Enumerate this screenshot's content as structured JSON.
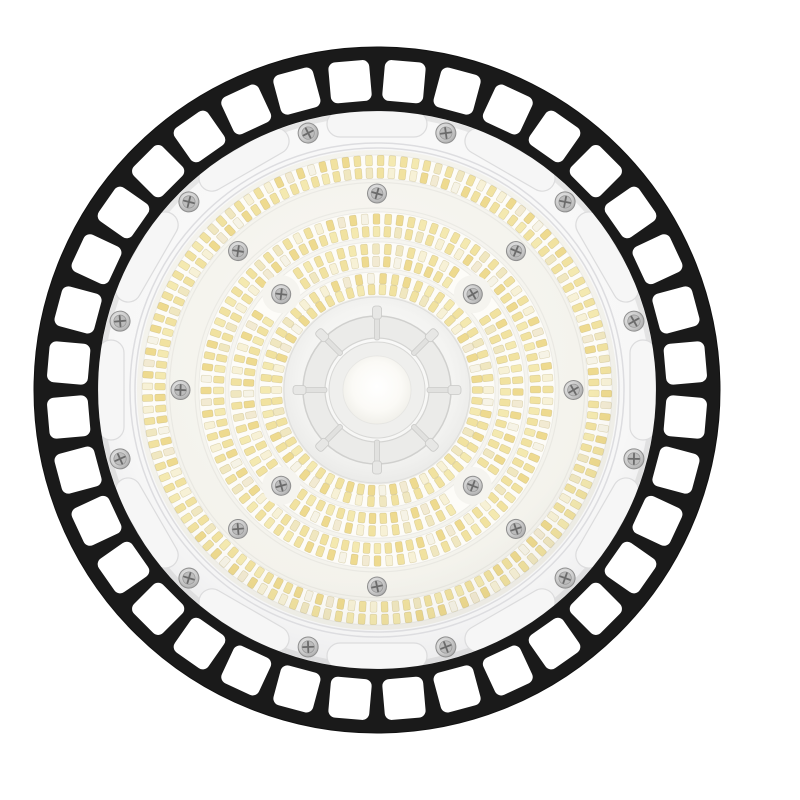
{
  "image": {
    "subject": "UFO LED high bay light fixture, front view, white background",
    "background_color": "#ffffff"
  },
  "fixture": {
    "center": {
      "x": 377,
      "y": 390
    },
    "cage": {
      "color": "#1a1a1a",
      "outer_radius": 343,
      "inner_radius": 279,
      "window_count": 36,
      "window_center_radius": 309.5,
      "window_size": 41,
      "window_corner_radius": 7,
      "first_window_angle_deg": 95,
      "window_fill": "#ffffff"
    },
    "bezel": {
      "outer_radius": 279,
      "recess_count": 12,
      "recess_center_radius": 266,
      "recess_width": 100,
      "recess_height": 26,
      "recess_fill": "#f6f6f6",
      "recess_stroke": "#dcdcdd",
      "groove_radii": [
        247,
        242
      ],
      "groove_color": "#dddde0",
      "screw_count": 12,
      "screw_ring_radius": 266,
      "screw_first_angle_deg": 15,
      "screw_head_radius": 10
    },
    "led_panel": {
      "tray_radius": 240,
      "tray_tint": "#f5f4ee",
      "gap_arc_radii": [
        207.5,
        182
      ],
      "band_backing_fill": "#fdfcf8",
      "bands": [
        {
          "r_inner": 94,
          "r_outer": 118,
          "row_radii": [
            100.5,
            111.5
          ],
          "chip_count": 58,
          "angle_offset": 0
        },
        {
          "r_inner": 122,
          "r_outer": 148,
          "row_radii": [
            128.5,
            141.0
          ],
          "chip_count": 75,
          "angle_offset": 4,
          "skip_near_inner_screws": true
        },
        {
          "r_inner": 152,
          "r_outer": 178,
          "row_radii": [
            158.5,
            171.0
          ],
          "chip_count": 92,
          "angle_offset": 8
        },
        {
          "r_inner": 211,
          "r_outer": 235,
          "row_radii": [
            217.0,
            229.5
          ],
          "chip_count": 124,
          "angle_offset": 2
        }
      ],
      "chip": {
        "width": 6.8,
        "height": 10.5,
        "corner": 1.6,
        "stroke": "rgba(176,158,92,0.35)",
        "palette": [
          "#f1e2a0",
          "#eeda8f",
          "#f4e9b0",
          "#f0e7c0",
          "#f7f1d6",
          "#f2ead2",
          "#f6f3e6"
        ]
      },
      "outer_screws": {
        "count": 8,
        "ring_radius": 196.5,
        "first_angle_deg": 0,
        "head_radius": 9.5
      },
      "inner_screws": {
        "count": 4,
        "ring_radius": 135.5,
        "first_angle_deg": 45,
        "head_radius": 9.5,
        "clearing_radius": 19,
        "clearing_fill": "#f5f4ef"
      }
    },
    "hub": {
      "clear_disc_radius": 93,
      "ring_outer_radius": 74,
      "ring_inner_radius": 52,
      "ring_fill": "#ebebe9",
      "rib_count": 8,
      "tab_radius": 77.5,
      "dome_radius": 48,
      "inner_dome_radius": 34
    },
    "screw_style": {
      "washer_stroke": "#8f8f8f",
      "inner_fill": "#bcbcbc",
      "cross_color": "#6b6b6b"
    }
  }
}
